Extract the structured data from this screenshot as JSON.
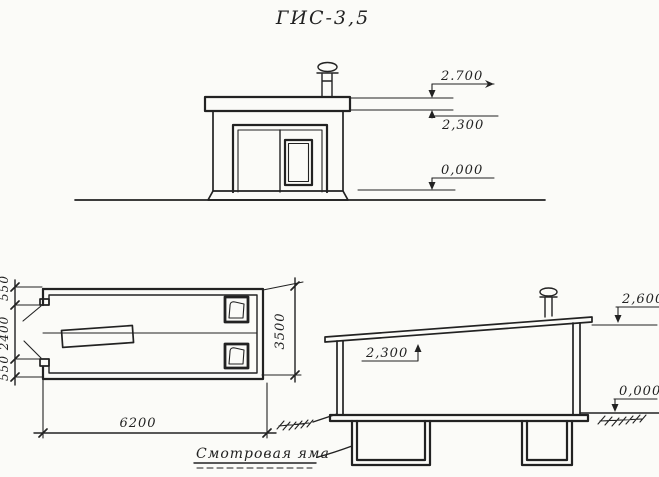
{
  "title": "ГИС-3,5",
  "colors": {
    "ink": "#222222",
    "paper": "#fbfbf8"
  },
  "front_elevation": {
    "level_roof_top": "2.700",
    "level_roof_bottom": "2,300",
    "level_ground": "0,000"
  },
  "plan": {
    "dim_left_top": "550",
    "dim_left_middle": "2400",
    "dim_left_bottom": "550",
    "dim_right": "3500",
    "dim_bottom": "6200"
  },
  "section": {
    "level_roof": "2,600",
    "level_ceiling": "2,300",
    "level_ground": "0,000",
    "pit_label": "Смотровая яма"
  }
}
